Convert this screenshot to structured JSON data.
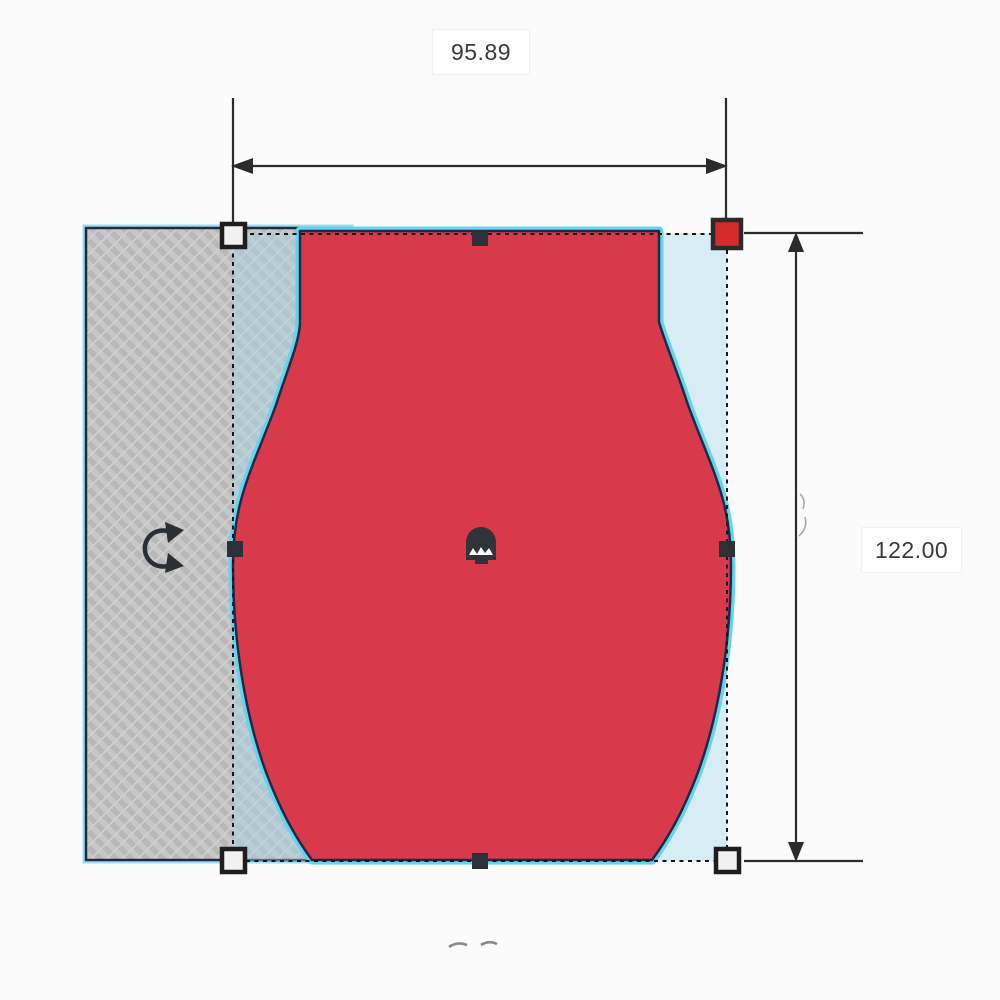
{
  "canvas": {
    "background": "#fbfbfb",
    "description": "3D design editor canvas with a selected shape being resized"
  },
  "dimension_annotations": {
    "width": {
      "value": "95.89"
    },
    "height": {
      "value": "122.00"
    }
  },
  "objects": {
    "selected_shape": {
      "label": "vase-profile-solid",
      "fill": "#d93a4b",
      "outline": "#1d2b46",
      "selection_glow": "#62d4ee"
    },
    "hatched_plate": {
      "label": "hatched-plate",
      "fill": "#c7c7c7",
      "stripe": "#b8b8b8",
      "outline": "#1d2b46",
      "selection_glow": "#9fdcec"
    },
    "selection_box": {
      "fill": "rgba(168,214,236,0.42)",
      "border_style": "dotted",
      "border_color": "#15151f"
    }
  },
  "handles": {
    "active_corner": {
      "position": "top-right",
      "fill": "#d42b2b",
      "border": "#2b2b2b"
    },
    "corner_fill": "#f1f1f1",
    "corner_border": "#1e1e1e",
    "midpoint_fill": "#2b3137",
    "corners": [
      "top-left",
      "top-right",
      "bottom-left",
      "bottom-right"
    ],
    "midpoints": [
      "top",
      "left",
      "right",
      "bottom"
    ]
  },
  "icons": {
    "rotate": "rotate-arrow-icon",
    "center_handle": "shape-center-handle-icon"
  },
  "dimension_line_color": "#2b2b2b"
}
